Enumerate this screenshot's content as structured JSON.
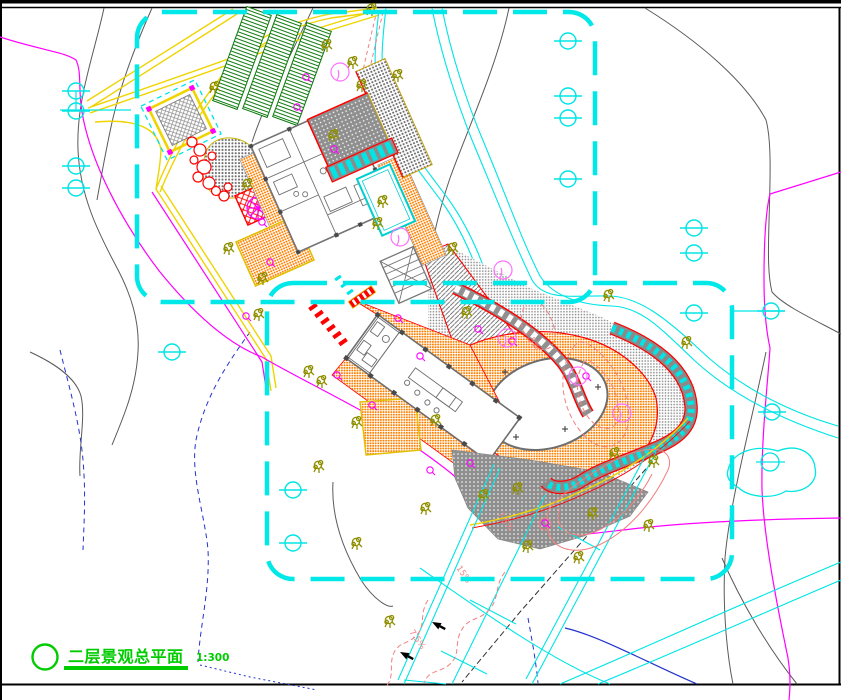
{
  "title_block": {
    "title": "二层景观总平面",
    "scale": "1:300"
  },
  "annotations": {
    "slope_labels": [
      "7.5%",
      "15%",
      "7.5%",
      "7.5%"
    ]
  },
  "palette": {
    "boundary_cyan": "#00E8E8",
    "water_cyan": "#00E5E5",
    "road_yellow": "#EFD400",
    "property_magenta": "#FF00FF",
    "contour_gray": "#5A5A5A",
    "contour_blue": "#2233CC",
    "contour_salmon": "#F08080",
    "paving_orange": "#FF8000",
    "planting_green": "#0E7A0E",
    "title_green": "#00CC00",
    "accent_red": "#FF0000",
    "tree_olive": "#8F8F00"
  }
}
